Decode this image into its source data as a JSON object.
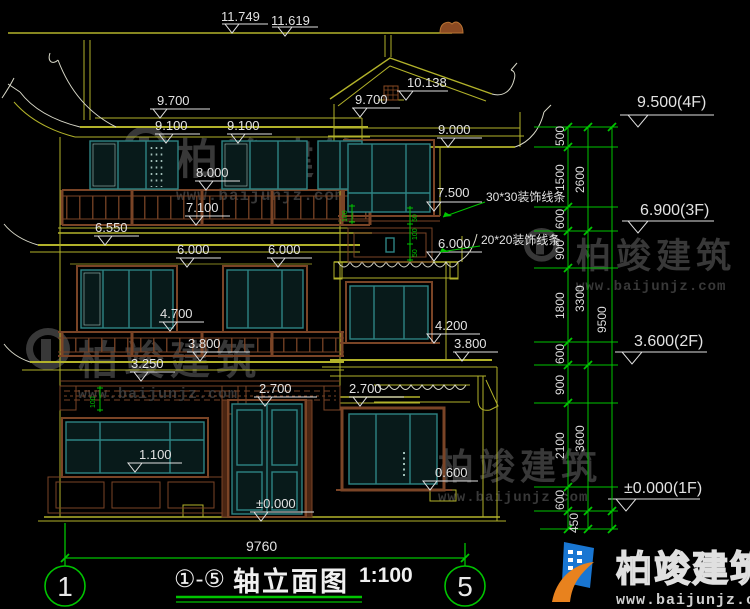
{
  "watermarks": {
    "brand": "柏竣建筑",
    "site": "www.baijunjz.com"
  },
  "colors": {
    "background": "#000000",
    "line_yellow": "#b2b22a",
    "line_white": "#d8d8c8",
    "window_teal": "#2e8484",
    "wood_brown": "#7a4426",
    "dim_green": "#00c400",
    "text_white": "#e2e2e2",
    "watermark_gray": "#383838",
    "logo_blue": "#1976d2",
    "logo_orange": "#e8821e"
  },
  "dims": {
    "d11749": "11.749",
    "d11619": "11.619",
    "d10138": "10.138",
    "d9700L": "9.700",
    "d9700C": "9.700",
    "d9100a": "9.100",
    "d9100b": "9.100",
    "d9000": "9.000",
    "d8000": "8.000",
    "d7500": "7.500",
    "d7100": "7.100",
    "d6550": "6.550",
    "d6000a": "6.000",
    "d6000b": "6.000",
    "d6000c": "6.000",
    "d4700": "4.700",
    "d4200": "4.200",
    "d3800L": "3.800",
    "d3800R": "3.800",
    "d3250": "3.250",
    "d2700a": "2.700",
    "d2700b": "2.700",
    "d1100": "1.100",
    "d0600": "0.600",
    "d0000": "±0.000"
  },
  "floors": {
    "f4": "9.500(4F)",
    "f3": "6.900(3F)",
    "f2": "3.600(2F)",
    "f1": "±0.000(1F)"
  },
  "chain": {
    "s500": "500",
    "s1500": "1500",
    "s600a": "600",
    "s900a": "900",
    "s1800": "1800",
    "s600b": "600",
    "s900b": "900",
    "s2100": "2100",
    "s600c": "600",
    "s450": "450",
    "sub2600": "2600",
    "sub3300": "3300",
    "sub3600": "3600",
    "total9500": "9500"
  },
  "annotations": {
    "trim30": "30*30装饰线条",
    "trim20": "20*20装饰线条"
  },
  "micro": {
    "a": "100",
    "b": "50",
    "c": "100",
    "d": "50",
    "e": "100"
  },
  "footer": {
    "overall": "9760",
    "axis1": "1",
    "axis5": "5",
    "range": "①-⑤",
    "title": "轴立面图",
    "scale": "1:100"
  }
}
